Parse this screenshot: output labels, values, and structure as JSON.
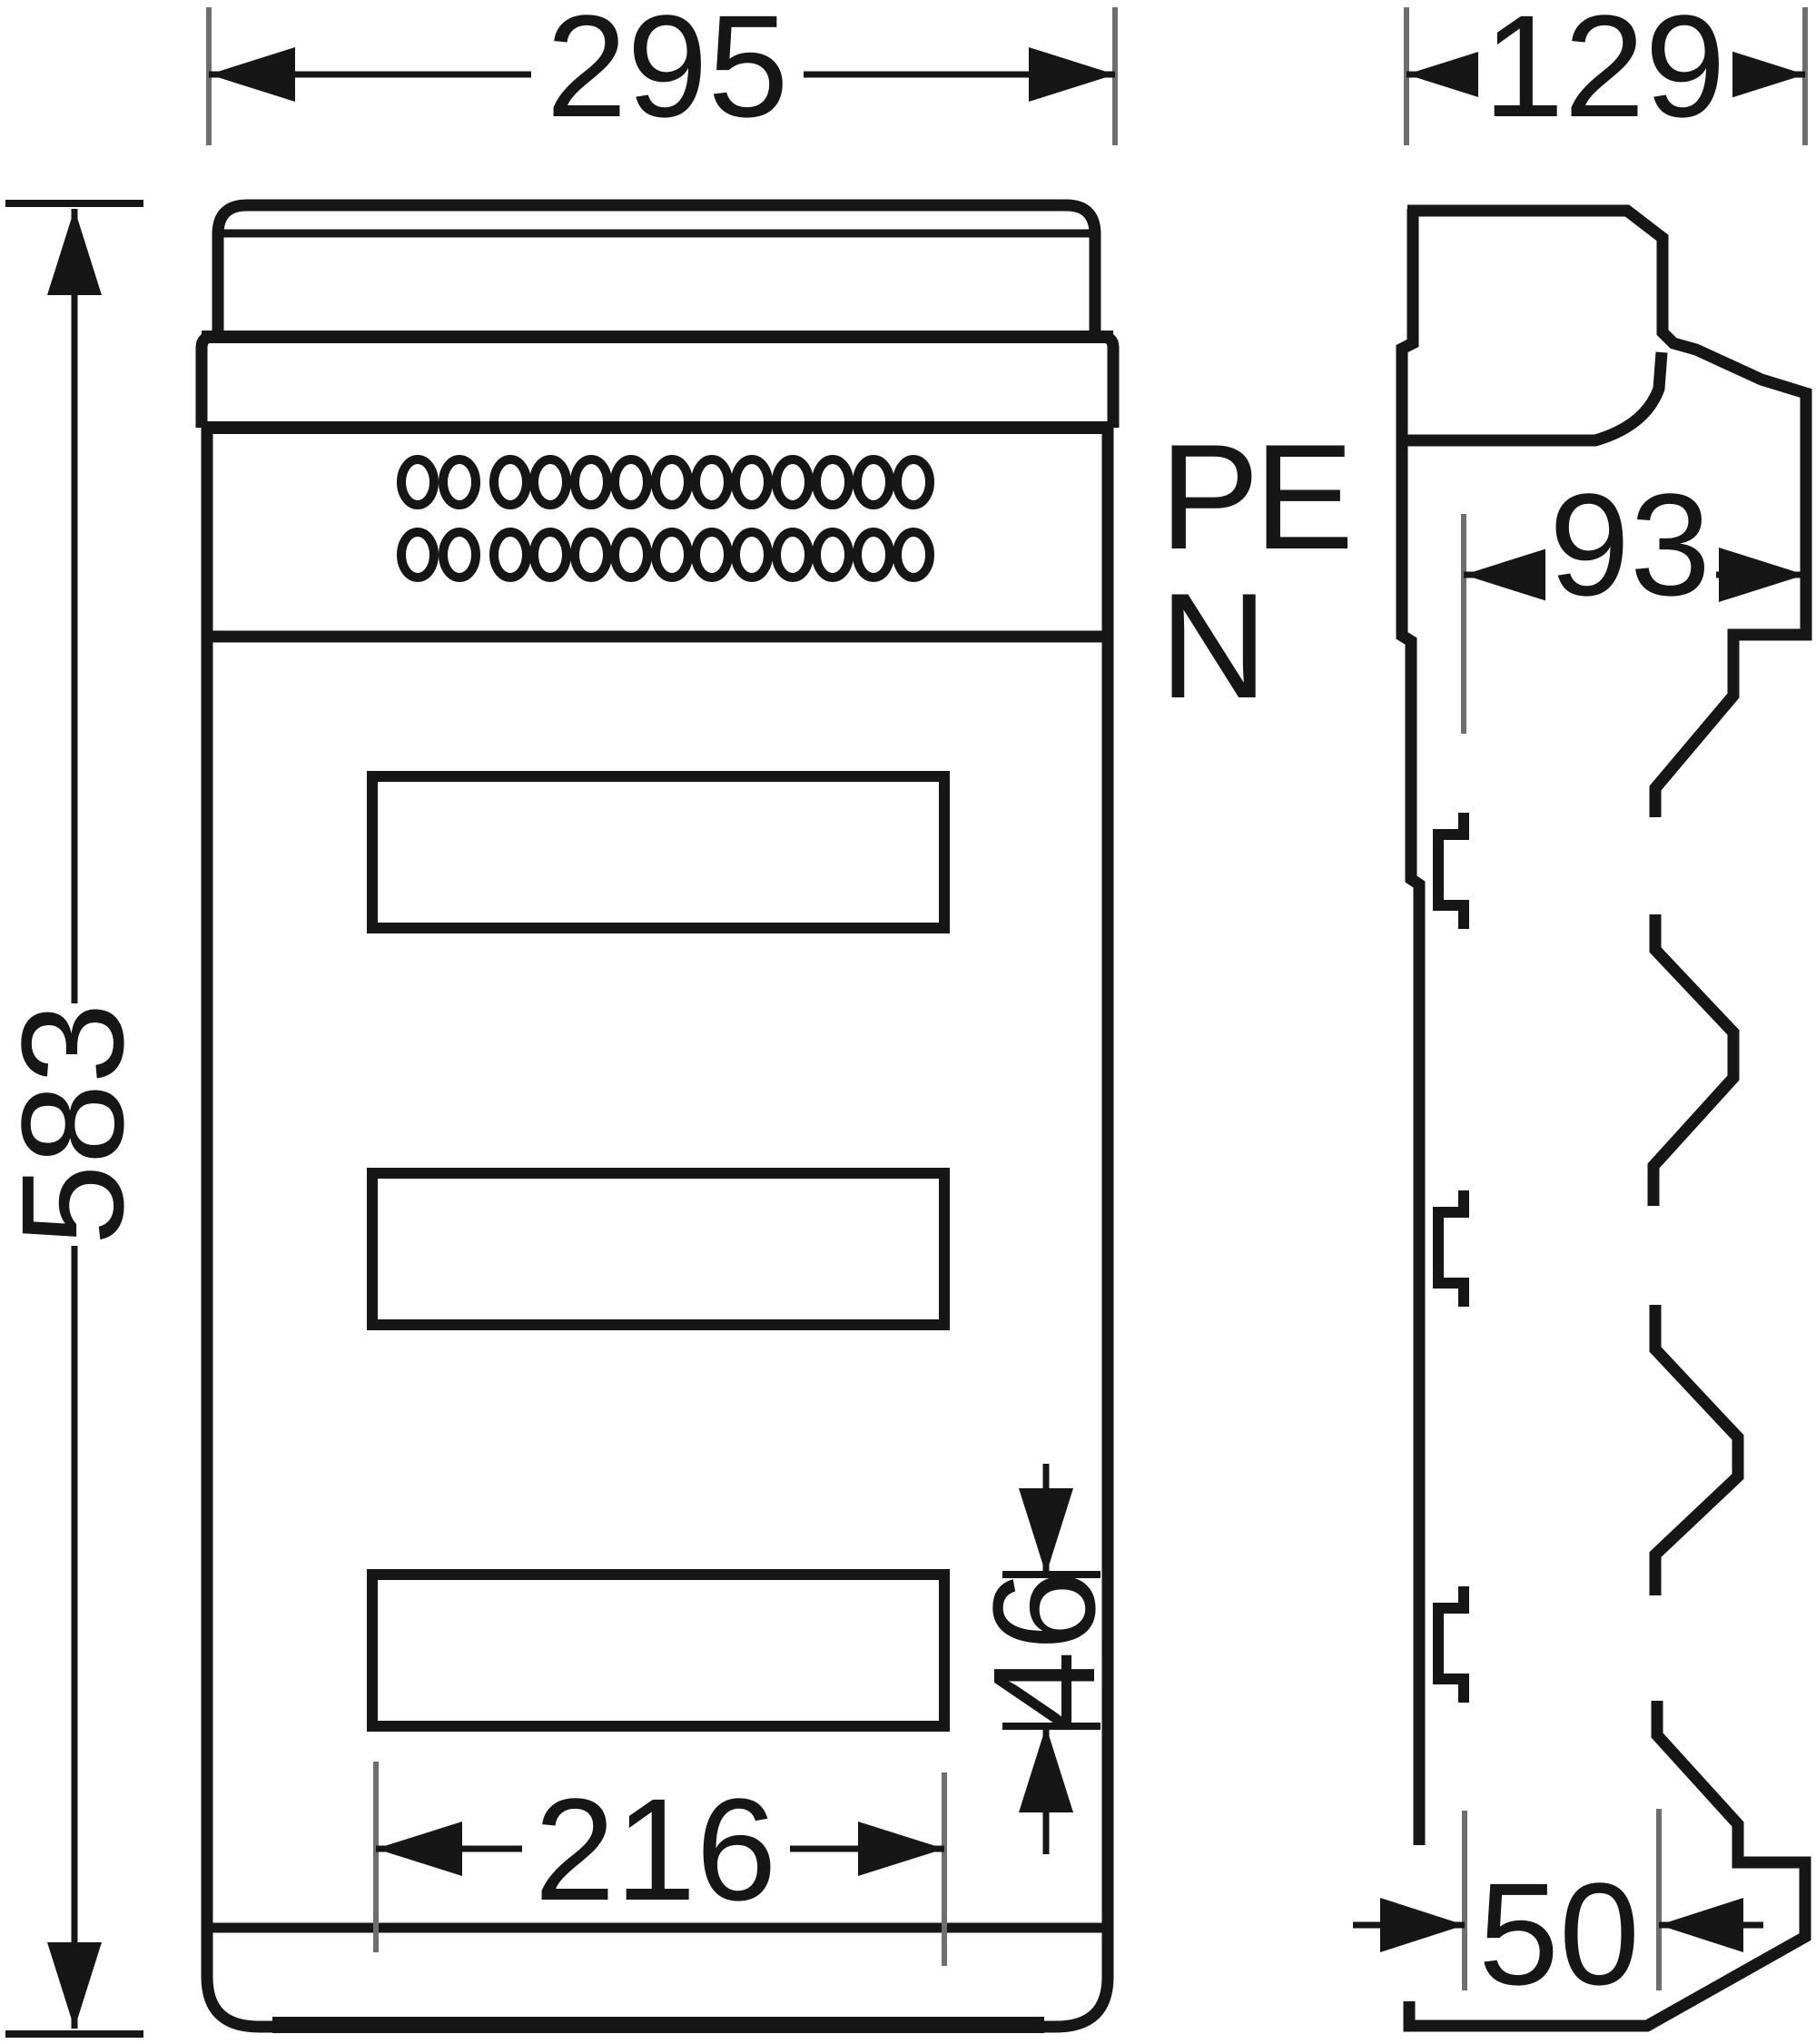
{
  "drawing": {
    "type": "enclosure-dimension-drawing",
    "views": {
      "front": "front-view",
      "side": "side-view"
    },
    "dimensions": {
      "overall_width": "295",
      "overall_height": "583",
      "cutout_width": "216",
      "cutout_height": "46",
      "overall_depth": "129",
      "body_depth": "93",
      "base_depth": "50"
    },
    "labels": {
      "protective_earth": "PE",
      "neutral": "N"
    },
    "structure": {
      "terminal_hole_rows": 2,
      "holes_per_row": 13,
      "cutout_windows": 3
    },
    "colors": {
      "line": "#161616",
      "extension_line": "#6e6e6e",
      "background": "#ffffff"
    }
  }
}
